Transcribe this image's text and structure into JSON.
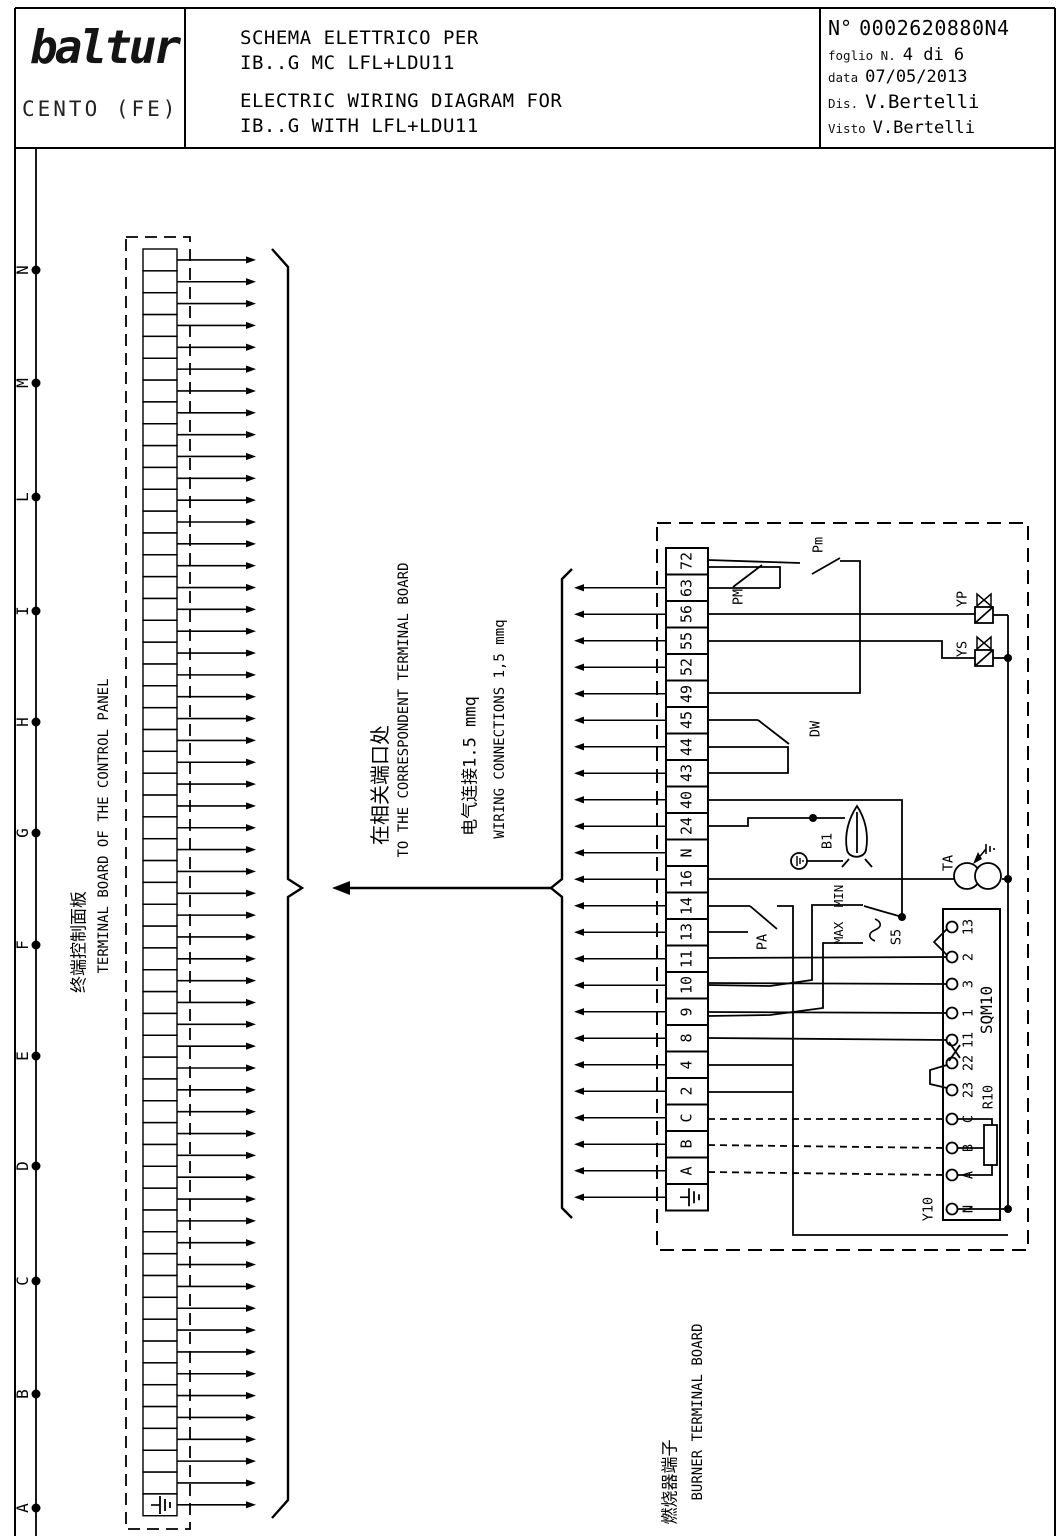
{
  "header": {
    "logo": "baltur",
    "logo_sub": "CENTO (FE)",
    "title_lines": [
      "SCHEMA ELETTRICO PER",
      "IB..G MC LFL+LDU11",
      "ELECTRIC WIRING DIAGRAM FOR",
      "IB..G WITH LFL+LDU11"
    ],
    "doc": {
      "number_label": "N°",
      "number": "0002620880N4",
      "sheet_label": "foglio N.",
      "sheet": "4 di 6",
      "date_label": "data",
      "date": "07/05/2013",
      "drawn_label": "Dis.",
      "drawn": "V.Bertelli",
      "checked_label": "Visto",
      "checked": "V.Bertelli"
    }
  },
  "zones": {
    "letters": [
      "N",
      "M",
      "L",
      "I",
      "H",
      "G",
      "F",
      "E",
      "D",
      "C",
      "B",
      "A"
    ]
  },
  "left_board": {
    "label_cn": "终端控制面板",
    "label_en": "TERMINAL BOARD OF THE CONTROL PANEL",
    "cells": 58
  },
  "annotations": {
    "line1_cn": "在相关端口处",
    "line1_en": "TO THE CORRESPONDENT TERMINAL BOARD",
    "line2_cn": "电气连接1.5 mmq",
    "line2_en": "WIRING CONNECTIONS 1,5 mmq"
  },
  "right_board": {
    "label_cn": "燃烧器端子",
    "label_en": "BURNER TERMINAL BOARD",
    "terminals": [
      "72",
      "63",
      "56",
      "55",
      "52",
      "49",
      "45",
      "44",
      "43",
      "40",
      "24",
      "N",
      "16",
      "14",
      "13",
      "11",
      "10",
      "9",
      "8",
      "4",
      "2",
      "C",
      "B",
      "A",
      "⏚"
    ]
  },
  "components": {
    "pm_max": "PM",
    "pm_min": "Pm",
    "dw": "DW",
    "b1": "B1",
    "ta": "TA",
    "pa": "PA",
    "min": "MIN",
    "max": "MAX",
    "s5": "S5",
    "sqm10": "SQM10",
    "r10": "R10",
    "y10": "Y10",
    "yp": "YP",
    "ys": "YS"
  },
  "sqm10_terminals": [
    "13",
    "2",
    "3",
    "1",
    "11",
    "22",
    "23",
    "C",
    "B",
    "A",
    "N"
  ]
}
